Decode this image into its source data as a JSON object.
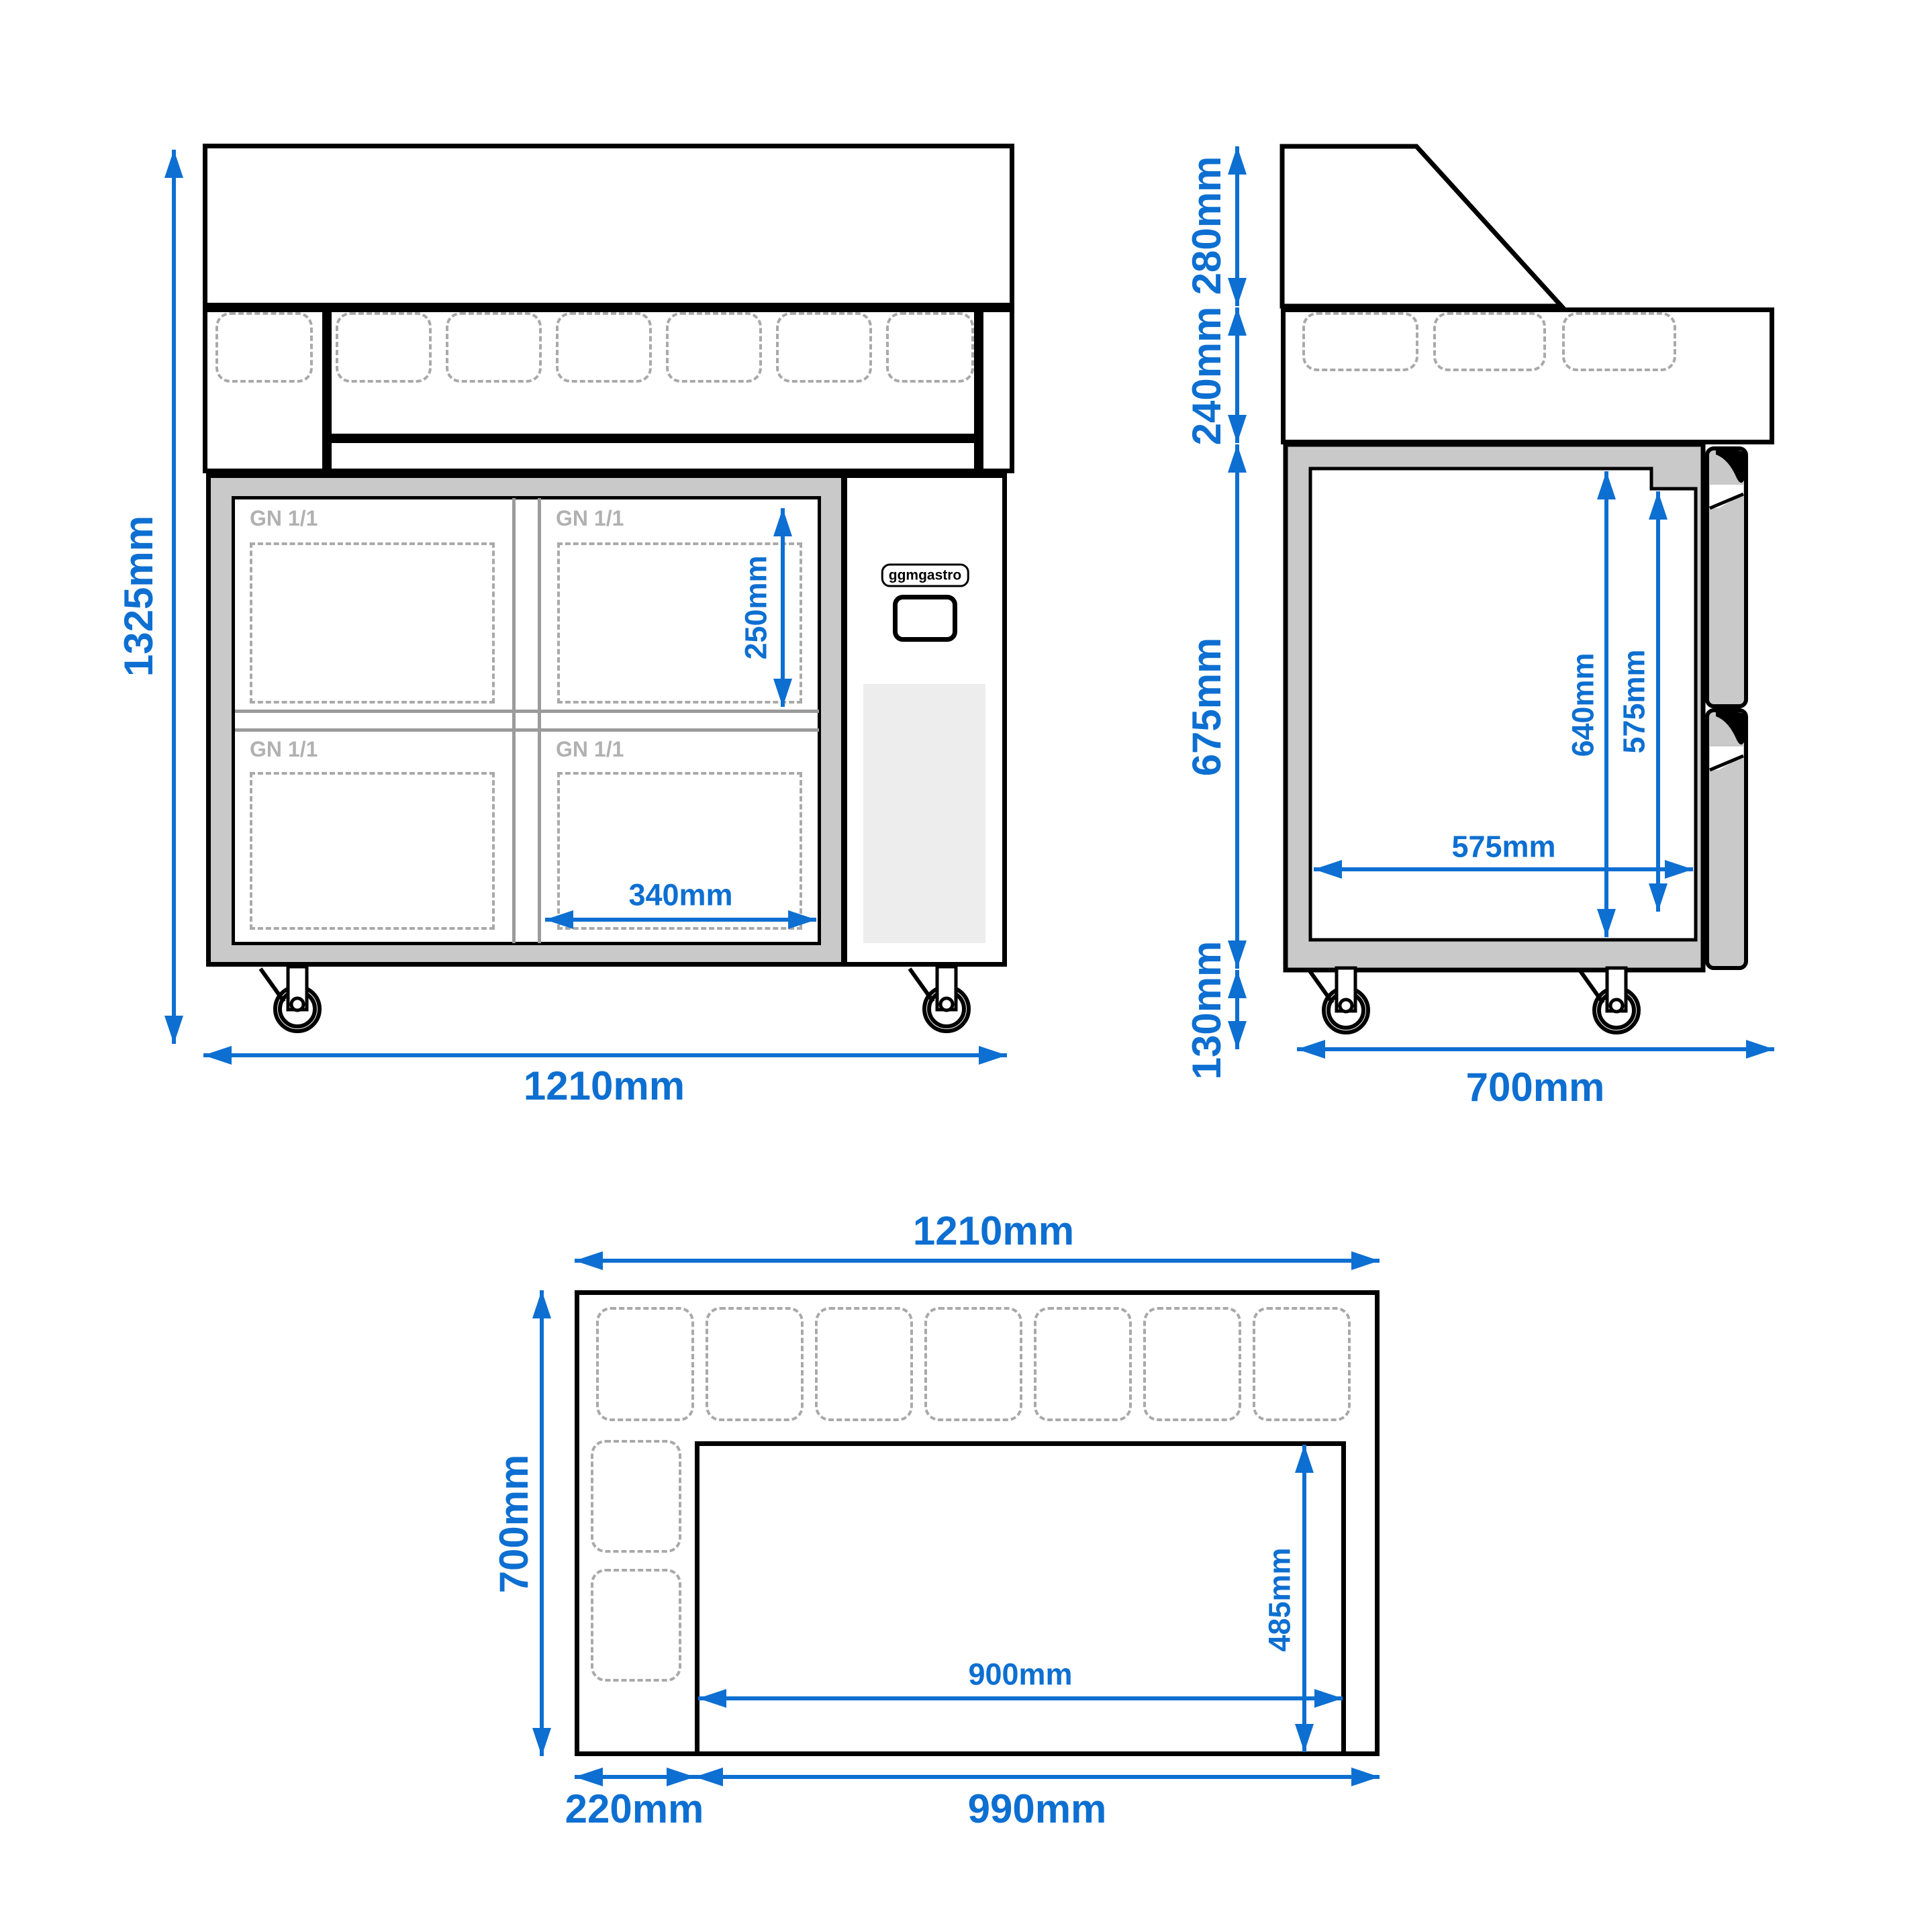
{
  "brand": {
    "logo_text": "ggmgastro"
  },
  "front_view": {
    "overall_height_label": "1325mm",
    "overall_width_label": "1210mm",
    "pan_depth_label": "250mm",
    "pan_width_label": "340mm",
    "gn_pan_labels": [
      "GN 1/1",
      "GN 1/1",
      "GN 1/1",
      "GN 1/1"
    ]
  },
  "side_view": {
    "glass_height_label": "280mm",
    "rail_height_label": "240mm",
    "body_height_label": "675mm",
    "caster_height_label": "130mm",
    "inner_height_label": "640mm",
    "drawer_height_label": "575mm",
    "inner_depth_label": "575mm",
    "overall_depth_label": "700mm"
  },
  "top_view": {
    "overall_width_label": "1210mm",
    "overall_depth_label": "700mm",
    "cutout_depth_label": "485mm",
    "cutout_width_label": "900mm",
    "left_section_label": "220mm",
    "right_section_label": "990mm"
  },
  "colors": {
    "dimension_blue": "#0d6fd1",
    "outline_black": "#000000",
    "frame_gray": "#c9c9c9",
    "panel_light_gray": "#ededed",
    "dashed_gray": "#a9a9a9",
    "gn_text_gray": "#b1b1b1"
  }
}
